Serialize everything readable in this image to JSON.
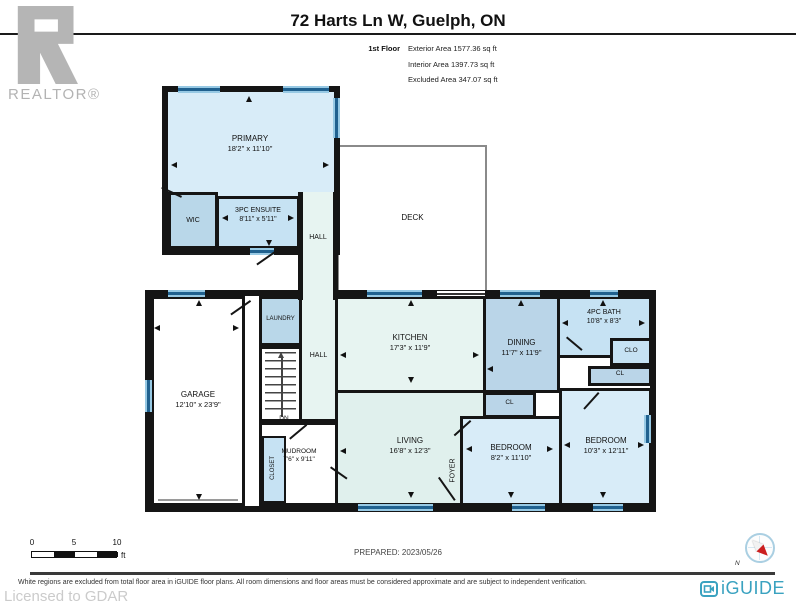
{
  "header": {
    "title": "72 Harts Ln W, Guelph, ON",
    "floor_label": "1st Floor",
    "stats": [
      "Exterior Area 1577.36 sq ft",
      "Interior Area 1397.73 sq ft",
      "Excluded Area 347.07 sq ft"
    ]
  },
  "realtor_logo": {
    "text": "REALTOR®"
  },
  "plan": {
    "rooms": {
      "primary": {
        "name": "PRIMARY",
        "dims": "18'2\" x 11'10\""
      },
      "wic": {
        "name": "WIC"
      },
      "ensuite": {
        "name": "3PC ENSUITE",
        "dims": "8'11\" x 5'11\""
      },
      "hall_upper": {
        "name": "HALL"
      },
      "deck": {
        "name": "DECK"
      },
      "laundry": {
        "name": "LAUNDRY"
      },
      "hall_main": {
        "name": "HALL"
      },
      "stairs": {
        "name": "DN"
      },
      "garage": {
        "name": "GARAGE",
        "dims": "12'10\" x 23'9\""
      },
      "mudroom": {
        "name": "MUDROOM",
        "dims": "7'6\" x 9'11\""
      },
      "closet": {
        "name": "CLOSET"
      },
      "kitchen": {
        "name": "KITCHEN",
        "dims": "17'3\" x 11'9\""
      },
      "living": {
        "name": "LIVING",
        "dims": "16'8\" x 12'3\""
      },
      "foyer": {
        "name": "FOYER"
      },
      "dining": {
        "name": "DINING",
        "dims": "11'7\" x 11'9\""
      },
      "bath": {
        "name": "4PC BATH",
        "dims": "10'8\" x 8'3\""
      },
      "clo": {
        "name": "CLO"
      },
      "cl_hall": {
        "name": "CL"
      },
      "cl_dining": {
        "name": "CL"
      },
      "bedroom_small": {
        "name": "BEDROOM",
        "dims": "8'2\" x 11'10\""
      },
      "bedroom_large": {
        "name": "BEDROOM",
        "dims": "10'3\" x 12'11\""
      }
    },
    "colors": {
      "wall": "#151515",
      "window": "#20618f",
      "room_light_blue": "#d8ecf8",
      "room_medium_blue": "#b9d7e9",
      "room_bath_blue": "#c6e2f3",
      "room_dining_blue": "#bad5e8",
      "room_cyan": "#e7f4f1",
      "room_living": "#e0f0ed",
      "excluded_white": "#ffffff",
      "brand_teal": "#3aa2c0",
      "logo_gray": "#b5b5b5"
    }
  },
  "scale_bar": {
    "ticks": [
      "0",
      "5",
      "10"
    ],
    "unit": "ft"
  },
  "prepared": "PREPARED: 2023/05/26",
  "compass": {
    "north_label": "N"
  },
  "footer": {
    "disclaimer": "White regions are excluded from total floor area in iGUIDE floor plans. All room dimensions and floor areas must be considered approximate and are subject to independent verification.",
    "licensed": "Licensed to GDAR",
    "brand": "iGUIDE"
  }
}
